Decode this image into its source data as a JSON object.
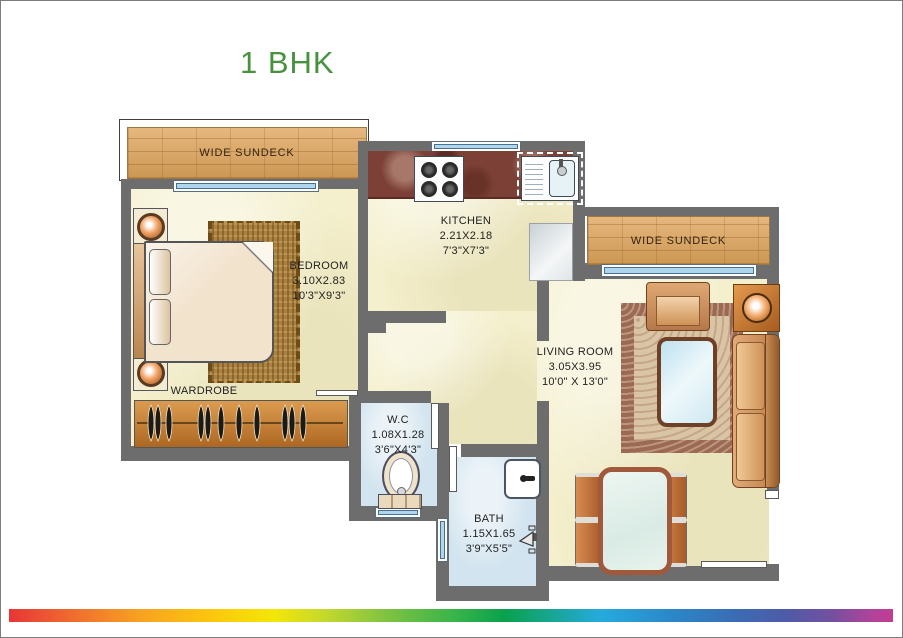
{
  "title": {
    "text": "1 BHK",
    "color": "#47923f"
  },
  "plan": {
    "sundeck_left": {
      "label": "WIDE SUNDECK"
    },
    "sundeck_right": {
      "label": "WIDE SUNDECK"
    },
    "bedroom": {
      "label": "BEDROOM",
      "dim_m": "3.10X2.83",
      "dim_ft": "10'3\"X9'3\""
    },
    "wardrobe": {
      "label": "WARDROBE"
    },
    "kitchen": {
      "label": "KITCHEN",
      "dim_m": "2.21X2.18",
      "dim_ft": "7'3\"X7'3\""
    },
    "living_room": {
      "label": "LIVING ROOM",
      "dim_m": "3.05X3.95",
      "dim_ft": "10'0\" X 13'0\""
    },
    "wc": {
      "label": "W.C",
      "dim_m": "1.08X1.28",
      "dim_ft": "3'6\"X4'3\""
    },
    "bath": {
      "label": "BATH",
      "dim_m": "1.15X1.65",
      "dim_ft": "3'9\"X5'5\""
    }
  },
  "colors": {
    "wall": "#6d6d6d",
    "floor_cream": "#f4efcc",
    "wet_floor_blue": "#d2e4ef",
    "window_blue": "#aed7ee",
    "brick_tan": "#d9a76b",
    "counter_marble": "#7c4036",
    "wood_orange": "#c9813d",
    "title_green": "#47923f"
  },
  "footer": {
    "type": "rainbow-gradient-bar",
    "colors": [
      "#e93537",
      "#ef6b30",
      "#f7a321",
      "#fdc70c",
      "#f4e607",
      "#86c440",
      "#3cb54a",
      "#0aa14c",
      "#26aade",
      "#2b87c8",
      "#3a6db4",
      "#4f5aa8",
      "#7350a0",
      "#c03d92"
    ]
  }
}
